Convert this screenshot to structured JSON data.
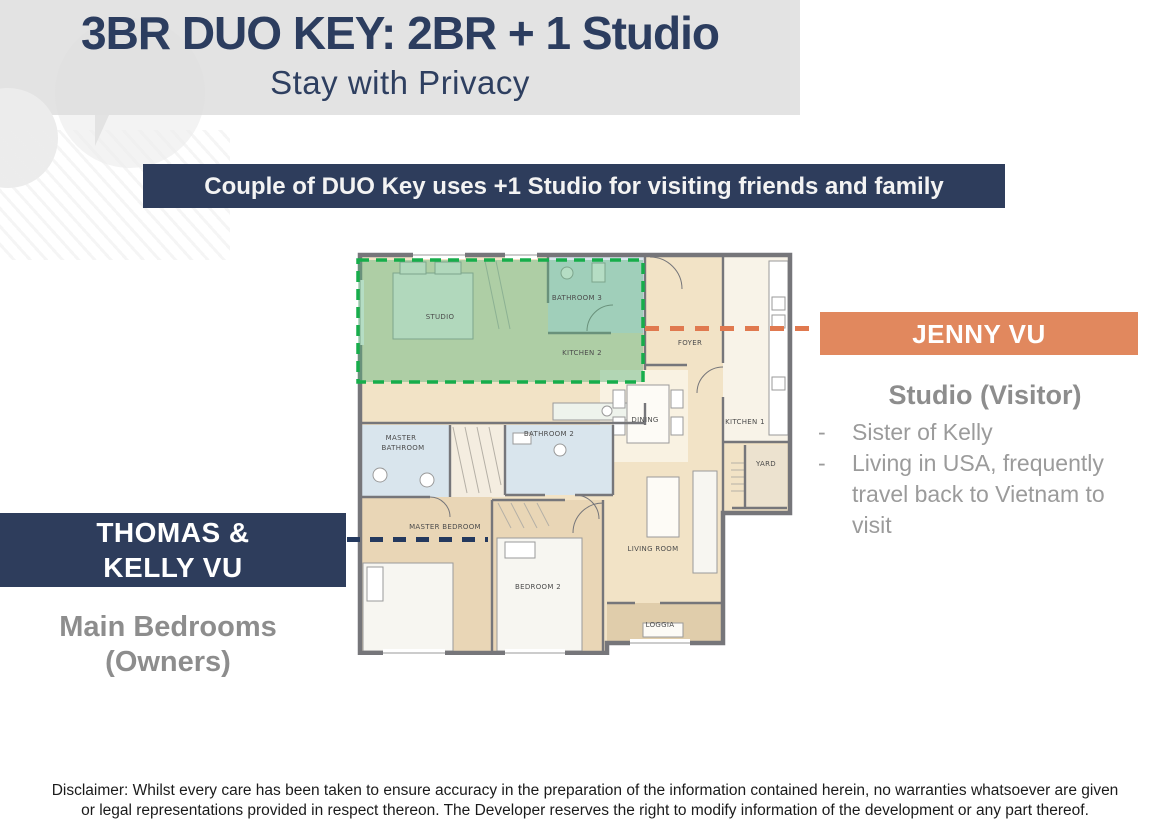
{
  "header": {
    "title": "3BR DUO KEY: 2BR + 1 Studio",
    "subtitle": "Stay with Privacy"
  },
  "banner": {
    "text": "Couple of DUO Key uses +1 Studio for visiting friends and family"
  },
  "jenny": {
    "name": "JENNY VU",
    "role": "Studio (Visitor)",
    "bullet_marker": "-",
    "bullets": [
      "Sister of Kelly",
      "Living in USA, frequently travel back to Vietnam to visit"
    ]
  },
  "owners": {
    "name_line1": "THOMAS &",
    "name_line2": "KELLY VU",
    "role_line1": "Main Bedrooms",
    "role_line2": "(Owners)"
  },
  "floor_plan": {
    "rooms": {
      "studio": "STUDIO",
      "bathroom3": "BATHROOM 3",
      "kitchen2": "KITCHEN 2",
      "foyer": "FOYER",
      "kitchen1": "KITCHEN 1",
      "dining": "DINING",
      "bathroom2": "BATHROOM 2",
      "master_bathroom_line1": "MASTER",
      "master_bathroom_line2": "BATHROOM",
      "master_bedroom": "MASTER BEDROOM",
      "bedroom2": "BEDROOM 2",
      "living_room": "LIVING ROOM",
      "loggia": "LOGGIA",
      "yard": "YARD"
    },
    "highlight": "studio-unit-green-zone"
  },
  "disclaimer": {
    "text": "Disclaimer: Whilst every care has been taken to ensure accuracy in the preparation of the information contained herein, no warranties whatsoever are given or legal representations provided in respect thereon. The Developer reserves the right to modify information of the development or any part thereof."
  },
  "colors": {
    "navy": "#2e3d5c",
    "orange": "#e1885e",
    "orange_line": "#e0794f",
    "header_gray": "#e3e3e3",
    "gray_text": "#8d8d8d",
    "green_fill": "#5ab47d",
    "green_dash": "#17ad4b",
    "wall_gray": "#76767a",
    "floor_beige": "#f2e3c6"
  }
}
